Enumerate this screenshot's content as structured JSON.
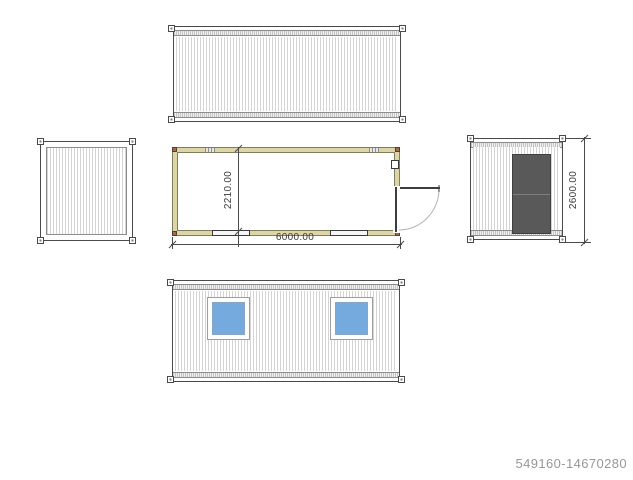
{
  "page": {
    "background": "#ffffff",
    "watermark": "549160-14670280"
  },
  "drawing": {
    "type": "container-house-technical-drawing",
    "views": [
      {
        "id": "roof-plan",
        "position": "top-center"
      },
      {
        "id": "end-elevation-blank",
        "position": "middle-left"
      },
      {
        "id": "floor-plan",
        "position": "middle-center"
      },
      {
        "id": "end-elevation-door",
        "position": "middle-right"
      },
      {
        "id": "side-elevation-windows",
        "position": "bottom-center"
      }
    ],
    "dimensions": {
      "plan_width": "2210.00",
      "plan_length": "6000.00",
      "end_height": "2600.00"
    },
    "colors": {
      "line": "#4a4a4a",
      "line_light": "#8c8c8c",
      "corrugation": "#d4d4d4",
      "band_fill": "#f0f0f0",
      "wall_fill": "#ddd5a5",
      "wall_line": "#7f7d60",
      "corner_brown": "#9c6b55",
      "corner_brown_dark": "#5e3b2b",
      "door_fill": "#595959",
      "door_line": "#3e3e3e",
      "glass_blue": "#74aadd",
      "frame_gray": "#9e9e9e",
      "dim_text": "#3c3c3c",
      "watermark": "#979797",
      "leaf_dark": "#3d3d3d",
      "arc_gray": "#b4b4b4"
    }
  }
}
